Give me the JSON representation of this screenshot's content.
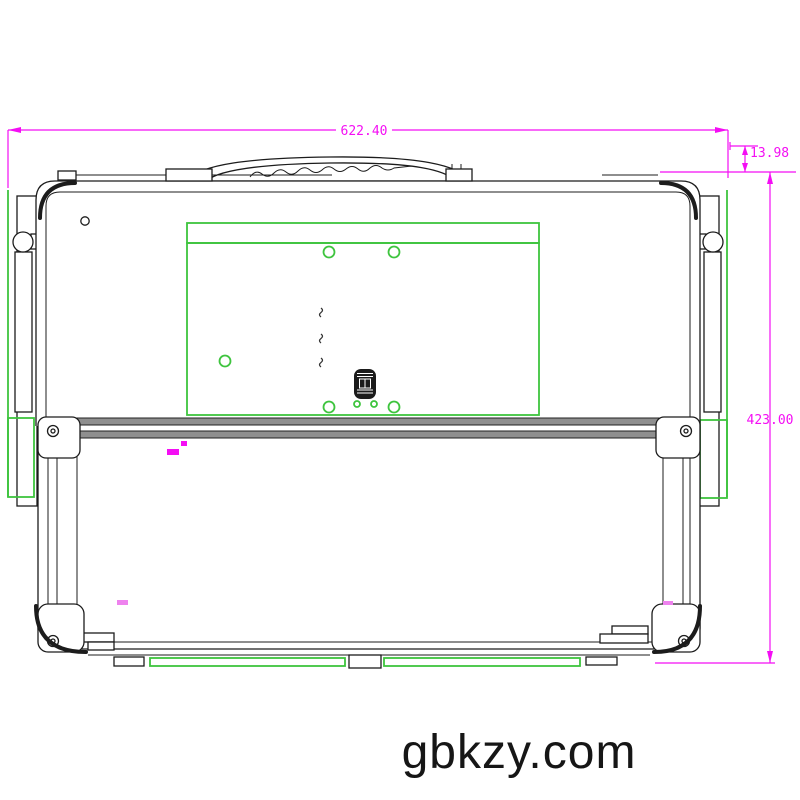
{
  "drawing": {
    "type": "cad-orthographic-view",
    "subject": "fold-up rackmount console rear view"
  },
  "colors": {
    "dimension_line": "#f40ef4",
    "construction_line": "#3ec43e",
    "drawing_line": "#1c1c1c",
    "background": "#ffffff"
  },
  "dimensions": {
    "overall_width": "622.40",
    "handle_offset": "13.98",
    "overall_height": "423.00"
  },
  "watermark": {
    "text": "gbkzy.com"
  }
}
